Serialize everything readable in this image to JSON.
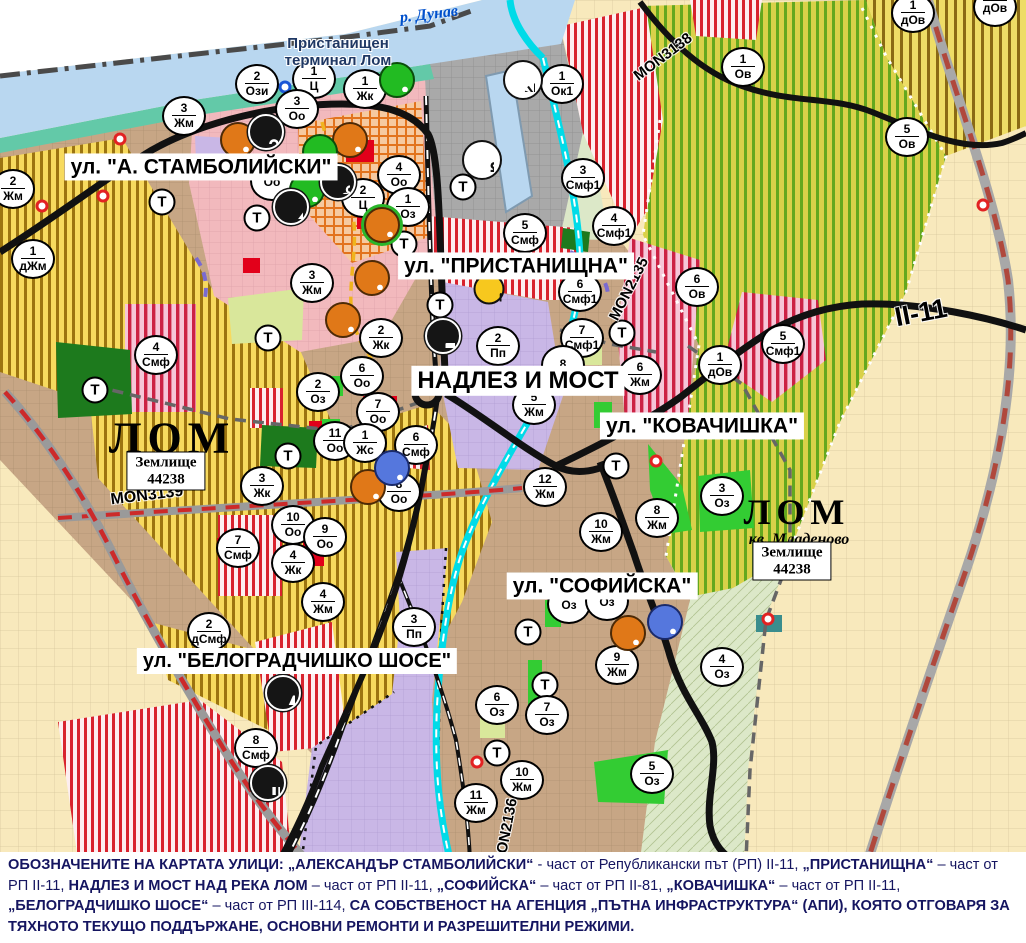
{
  "map": {
    "palette": {
      "water": "#b9d7f0",
      "shore": "#63c9a8",
      "port_gray": "#a9a9a9",
      "vineyard": "#d9d149",
      "vineyard_stripe": "#64a81e",
      "yellow_zone": "#f7da5e",
      "yellow_stripe": "#9c7410",
      "town_brown": "#c7a685",
      "farmland": "#f8e9bc",
      "floodplain": "#dce8c8",
      "purple_zone": "#c9b7e6",
      "pink_zone": "#f2b9bd",
      "red_stripe": "#d8232e",
      "red_solid": "#e2001a",
      "green_park": "#33cc33",
      "dark_green": "#1d7a1d",
      "pale_green": "#d9e79b",
      "road_black": "#111111",
      "river_cyan": "#00dbe8",
      "red_dash_road": "#cc2a2a",
      "marker_orange": "#e07818",
      "marker_green": "#22bb22",
      "marker_blue": "#5577dd",
      "legend_text": "#151560",
      "terminal_text": "#1f3864",
      "river_label": "#0050cc"
    },
    "street_labels": [
      {
        "text": "ул. \"А. СТАМБОЛИЙСКИ\"",
        "x": 201,
        "y": 167,
        "size": 21
      },
      {
        "text": "ул. \"ПРИСТАНИЩНА\"",
        "x": 516,
        "y": 266,
        "size": 21
      },
      {
        "text": "НАДЛЕЗ И МОСТ",
        "x": 518,
        "y": 381,
        "size": 24
      },
      {
        "text": "ул. \"КОВАЧИШКА\"",
        "x": 702,
        "y": 426,
        "size": 21
      },
      {
        "text": "ул. \"СОФИЙСКА\"",
        "x": 602,
        "y": 586,
        "size": 21
      },
      {
        "text": "ул. \"БЕЛОГРАДЧИШКО ШОСЕ\"",
        "x": 297,
        "y": 661,
        "size": 20
      }
    ],
    "road_labels": [
      {
        "text": "MON3138",
        "x": 663,
        "y": 57,
        "rot": -37,
        "size": 15
      },
      {
        "text": "MON2135",
        "x": 629,
        "y": 289,
        "rot": -63,
        "size": 15
      },
      {
        "text": "MON3139",
        "x": 147,
        "y": 496,
        "rot": -7,
        "size": 16
      },
      {
        "text": "MON2136",
        "x": 506,
        "y": 832,
        "rot": -79,
        "size": 15
      },
      {
        "text": "II-11",
        "x": 921,
        "y": 313,
        "rot": -11,
        "size": 27
      }
    ],
    "place_labels": [
      {
        "text": "ЛОМ",
        "x": 172,
        "y": 438,
        "size": 44,
        "cls": "city"
      },
      {
        "text": "ЛОМ",
        "x": 797,
        "y": 512,
        "size": 36,
        "cls": "city"
      },
      {
        "text": "кв. Младеново",
        "x": 799,
        "y": 540,
        "size": 16,
        "cls": "quarter"
      },
      {
        "text": "Пристанищен\nтерминал Лом",
        "x": 338,
        "y": 52,
        "size": 15,
        "cls": "terminal"
      },
      {
        "text": "р. Дунав",
        "x": 429,
        "y": 15,
        "size": 16,
        "cls": "river",
        "rot": -7
      }
    ],
    "landholding_boxes": [
      {
        "line1": "Землище",
        "line2": "44238",
        "x": 166,
        "y": 471
      },
      {
        "line1": "Землище",
        "line2": "44238",
        "x": 792,
        "y": 561
      }
    ],
    "t_label": "Т",
    "t_markers": [
      [
        162,
        202
      ],
      [
        257,
        218
      ],
      [
        268,
        338
      ],
      [
        95,
        390
      ],
      [
        288,
        456
      ],
      [
        404,
        244
      ],
      [
        463,
        187
      ],
      [
        440,
        305
      ],
      [
        622,
        333
      ],
      [
        616,
        466
      ],
      [
        528,
        632
      ],
      [
        545,
        685
      ],
      [
        497,
        753
      ]
    ],
    "zone_markers": [
      {
        "x": 257,
        "y": 84,
        "num": "2",
        "label": "Ози"
      },
      {
        "x": 314,
        "y": 79,
        "num": "1",
        "label": "Ц"
      },
      {
        "x": 365,
        "y": 89,
        "num": "1",
        "label": "Жк"
      },
      {
        "x": 297,
        "y": 109,
        "num": "3",
        "label": "Оо"
      },
      {
        "x": 184,
        "y": 116,
        "num": "3",
        "label": "Жм"
      },
      {
        "x": 562,
        "y": 84,
        "num": "1",
        "label": "Ок1"
      },
      {
        "x": 13,
        "y": 189,
        "num": "2",
        "label": "Жм"
      },
      {
        "x": 33,
        "y": 259,
        "num": "1",
        "label": "дЖм"
      },
      {
        "x": 272,
        "y": 181,
        "num": "",
        "label": "Оо"
      },
      {
        "x": 312,
        "y": 283,
        "num": "3",
        "label": "Жм"
      },
      {
        "x": 399,
        "y": 175,
        "num": "4",
        "label": "Оо"
      },
      {
        "x": 408,
        "y": 207,
        "num": "1",
        "label": "Оз"
      },
      {
        "x": 363,
        "y": 198,
        "num": "2",
        "label": "Ц"
      },
      {
        "x": 583,
        "y": 178,
        "num": "3",
        "label": "Смф1"
      },
      {
        "x": 614,
        "y": 226,
        "num": "4",
        "label": "Смф1"
      },
      {
        "x": 525,
        "y": 233,
        "num": "5",
        "label": "Смф"
      },
      {
        "x": 580,
        "y": 292,
        "num": "6",
        "label": "Смф1"
      },
      {
        "x": 582,
        "y": 338,
        "num": "7",
        "label": "Смф1"
      },
      {
        "x": 498,
        "y": 346,
        "num": "2",
        "label": "Пп"
      },
      {
        "x": 381,
        "y": 338,
        "num": "2",
        "label": "Жк"
      },
      {
        "x": 362,
        "y": 376,
        "num": "6",
        "label": "Оо"
      },
      {
        "x": 378,
        "y": 412,
        "num": "7",
        "label": "Оо"
      },
      {
        "x": 335,
        "y": 441,
        "num": "11",
        "label": "Оо"
      },
      {
        "x": 365,
        "y": 443,
        "num": "1",
        "label": "Жс"
      },
      {
        "x": 416,
        "y": 445,
        "num": "6",
        "label": "Смф"
      },
      {
        "x": 318,
        "y": 392,
        "num": "2",
        "label": "Оз"
      },
      {
        "x": 399,
        "y": 492,
        "num": "8",
        "label": "Оо"
      },
      {
        "x": 293,
        "y": 525,
        "num": "10",
        "label": "Оо"
      },
      {
        "x": 325,
        "y": 537,
        "num": "9",
        "label": "Оо"
      },
      {
        "x": 293,
        "y": 563,
        "num": "4",
        "label": "Жк"
      },
      {
        "x": 323,
        "y": 602,
        "num": "4",
        "label": "Жм"
      },
      {
        "x": 238,
        "y": 548,
        "num": "7",
        "label": "Смф"
      },
      {
        "x": 209,
        "y": 632,
        "num": "2",
        "label": "дСмф"
      },
      {
        "x": 256,
        "y": 748,
        "num": "8",
        "label": "Смф"
      },
      {
        "x": 262,
        "y": 486,
        "num": "3",
        "label": "Жк"
      },
      {
        "x": 156,
        "y": 355,
        "num": "4",
        "label": "Смф"
      },
      {
        "x": 563,
        "y": 365,
        "num": "8",
        "label": ""
      },
      {
        "x": 534,
        "y": 405,
        "num": "5",
        "label": "Жм"
      },
      {
        "x": 545,
        "y": 487,
        "num": "12",
        "label": "Жм"
      },
      {
        "x": 640,
        "y": 375,
        "num": "6",
        "label": "Жм"
      },
      {
        "x": 722,
        "y": 496,
        "num": "3",
        "label": "Оз"
      },
      {
        "x": 657,
        "y": 518,
        "num": "8",
        "label": "Жм"
      },
      {
        "x": 601,
        "y": 532,
        "num": "10",
        "label": "Жм"
      },
      {
        "x": 617,
        "y": 665,
        "num": "9",
        "label": "Жм"
      },
      {
        "x": 722,
        "y": 667,
        "num": "4",
        "label": "Оз"
      },
      {
        "x": 652,
        "y": 774,
        "num": "5",
        "label": "Оз"
      },
      {
        "x": 497,
        "y": 705,
        "num": "6",
        "label": "Оз"
      },
      {
        "x": 547,
        "y": 715,
        "num": "7",
        "label": "Оз"
      },
      {
        "x": 522,
        "y": 780,
        "num": "10",
        "label": "Жм"
      },
      {
        "x": 476,
        "y": 803,
        "num": "11",
        "label": "Жм"
      },
      {
        "x": 414,
        "y": 627,
        "num": "3",
        "label": "Пп"
      },
      {
        "x": 569,
        "y": 604,
        "num": "",
        "label": "Оз"
      },
      {
        "x": 607,
        "y": 601,
        "num": "",
        "label": "Оз"
      },
      {
        "x": 743,
        "y": 67,
        "num": "1",
        "label": "Ов"
      },
      {
        "x": 907,
        "y": 137,
        "num": "5",
        "label": "Ов"
      },
      {
        "x": 913,
        "y": 13,
        "num": "1",
        "label": "дОв"
      },
      {
        "x": 995,
        "y": 7,
        "num": "",
        "label": "дОв"
      },
      {
        "x": 697,
        "y": 287,
        "num": "6",
        "label": "Ов"
      },
      {
        "x": 720,
        "y": 365,
        "num": "1",
        "label": "дОв"
      },
      {
        "x": 783,
        "y": 344,
        "num": "5",
        "label": "Смф1"
      }
    ],
    "poi_icons": [
      {
        "type": "culture",
        "color": "orange",
        "x": 238,
        "y": 140
      },
      {
        "type": "culture",
        "color": "orange",
        "x": 350,
        "y": 140
      },
      {
        "type": "culture",
        "color": "orange",
        "x": 372,
        "y": 278
      },
      {
        "type": "culture",
        "color": "orange",
        "x": 343,
        "y": 320
      },
      {
        "type": "culture",
        "color": "orange",
        "ringed": true,
        "x": 382,
        "y": 225
      },
      {
        "type": "culture",
        "color": "orange",
        "x": 368,
        "y": 487
      },
      {
        "type": "culture",
        "color": "orange",
        "x": 628,
        "y": 633
      },
      {
        "type": "culture",
        "color": "green",
        "x": 397,
        "y": 80
      },
      {
        "type": "culture",
        "color": "green",
        "x": 320,
        "y": 152
      },
      {
        "type": "culture",
        "color": "green",
        "x": 307,
        "y": 190
      },
      {
        "type": "culture",
        "color": "blue",
        "x": 392,
        "y": 468
      },
      {
        "type": "culture",
        "color": "blue",
        "x": 665,
        "y": 622
      },
      {
        "type": "key",
        "color": "black",
        "x": 266,
        "y": 132
      },
      {
        "type": "trefoil",
        "color": "black",
        "x": 338,
        "y": 182
      },
      {
        "type": "mountain",
        "color": "black",
        "x": 291,
        "y": 207
      },
      {
        "type": "anchor",
        "color": "white",
        "x": 482,
        "y": 160
      },
      {
        "type": "sun",
        "color": "white",
        "x": 523,
        "y": 80
      },
      {
        "type": "warning",
        "color": "yellow",
        "x": 489,
        "y": 289
      },
      {
        "type": "truck",
        "color": "black",
        "x": 443,
        "y": 336
      },
      {
        "type": "lightning",
        "color": "black",
        "x": 283,
        "y": 693
      },
      {
        "type": "factory",
        "color": "black",
        "x": 268,
        "y": 783
      }
    ],
    "ring_markers": [
      {
        "x": 120,
        "y": 139,
        "color": "red"
      },
      {
        "x": 42,
        "y": 206,
        "color": "red"
      },
      {
        "x": 103,
        "y": 196,
        "color": "red"
      },
      {
        "x": 656,
        "y": 461,
        "color": "red"
      },
      {
        "x": 477,
        "y": 762,
        "color": "red"
      },
      {
        "x": 768,
        "y": 619,
        "color": "red"
      },
      {
        "x": 983,
        "y": 205,
        "color": "red"
      },
      {
        "x": 285,
        "y": 87,
        "color": "blue"
      }
    ],
    "legend": {
      "segments": [
        {
          "text": "ОБОЗНАЧЕНИТЕ НА КАРТАТА УЛИЦИ: „АЛЕКСАНДЪР СТАМБОЛИЙСКИ“",
          "bold": true
        },
        {
          "text": " - част от Републикански път (РП) II-11, ",
          "bold": false
        },
        {
          "text": "„ПРИСТАНИЩНА“",
          "bold": true
        },
        {
          "text": " – част от РП II-11, ",
          "bold": false
        },
        {
          "text": "НАДЛЕЗ И МОСТ НАД РЕКА ЛОМ",
          "bold": true
        },
        {
          "text": " – част от РП II-11, ",
          "bold": false
        },
        {
          "text": "„СОФИЙСКА“",
          "bold": true
        },
        {
          "text": " – част от РП II-81, ",
          "bold": false
        },
        {
          "text": "„КОВАЧИШКА“",
          "bold": true
        },
        {
          "text": " – част от РП II-11, ",
          "bold": false
        },
        {
          "text": "„БЕЛОГРАДЧИШКО ШОСЕ“",
          "bold": true
        },
        {
          "text": " – част от РП III-114, ",
          "bold": false
        },
        {
          "text": "СА СОБСТВЕНОСТ НА АГЕНЦИЯ „ПЪТНА ИНФРАСТРУКТУРА“ (АПИ), КОЯТО ОТГОВАРЯ ЗА ТЯХНОТО ТЕКУЩО ПОДДЪРЖАНЕ, ОСНОВНИ РЕМОНТИ И РАЗРЕШИТЕЛНИ РЕЖИМИ.",
          "bold": true
        }
      ]
    }
  }
}
